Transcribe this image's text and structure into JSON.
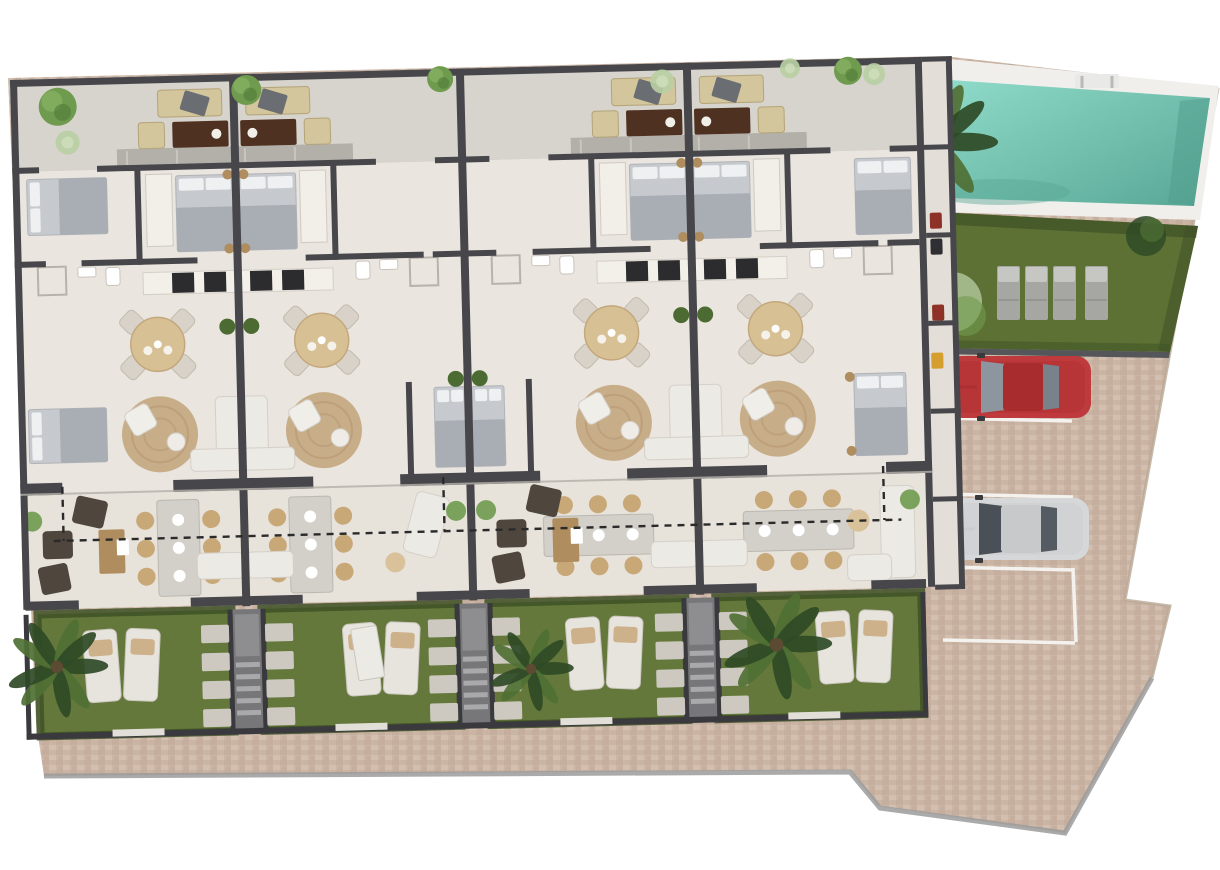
{
  "meta": {
    "kind": "architectural-site-plan",
    "view": "top-down 3d render",
    "units_count": 4,
    "description": "Four mirrored townhouse units with roof terraces, gardens, communal pool, lawn and parking"
  },
  "palette": {
    "background": "#ffffff",
    "paving": "#cbb6a6",
    "paving_dark": "#c0a897",
    "paving_light": "#d7c4b5",
    "curb": "#9b9b9b",
    "wall": "#47474b",
    "wall_dark": "#3a3a3e",
    "floor_interior": "#eae5de",
    "floor_terrace": "#d7d3cd",
    "floor_lower": "#e7e2da",
    "floor_strip": "#e3ded7",
    "balcony": "#b3afa9",
    "lawn": "#64783b",
    "lawn_dark": "#3e5126",
    "lawn_pool": "#5d7134",
    "pool_water": "#8fdac9",
    "pool_water_deep": "#58a795",
    "pool_deck": "#f1efec",
    "stone": "#d3cec7",
    "path_concrete": "#77777a",
    "step_tread": "#a9a9ac",
    "sofa_beige": "#d3c59c",
    "wood_dark": "#4e3121",
    "wood_mid": "#b08d5e",
    "rug_jute": "#c8ad89",
    "table_round_top": "#d8c095",
    "chair_pale": "#d8d2c8",
    "chair_tan": "#c9a877",
    "bed_light": "#c6c9cd",
    "bed_blanket": "#a9adb4",
    "pillow": "#eef0f2",
    "white_furniture": "#eceae5",
    "appliance_dark": "#2c2c2e",
    "plant_green": "#6f9b4e",
    "plant_pale": "#b9cfa4",
    "palm_dark": "#2f4a26",
    "palm_mid": "#4f7034",
    "dashed_line": "#2a2a2a",
    "lounger_gray": "#a6a7a2",
    "lounger_gray_top": "#c6c7c3",
    "car_red": "#bf3a3c",
    "car_red_roof": "#a82c2e",
    "car_silver": "#d6d7d9",
    "car_silver_roof": "#c8c9cb",
    "car_glass": "#8d969e",
    "car_glass_dark": "#4a5058",
    "accent_red_item": "#8e3127",
    "accent_yellow_item": "#d49f2e"
  },
  "units": [
    {
      "id": 1,
      "x0": 0,
      "x1": 223,
      "divider": "right",
      "table_orientation": "vertical",
      "lounge_accent": "dark-armchairs",
      "outer_bedrooms": "horizontal",
      "garden": {
        "loungers_x": 60,
        "palm": {
          "x": 32,
          "y": 588,
          "r": 48
        },
        "gate_x": 112
      }
    },
    {
      "id": 2,
      "x0": 223,
      "x1": 450,
      "divider": "left",
      "table_orientation": "vertical",
      "lounge_accent": "white-chaise",
      "mid_bed": "right",
      "garden": {
        "loungers_x": 320,
        "shed": {
          "x": 330,
          "y": 556
        },
        "gate_x": 335
      }
    },
    {
      "id": 3,
      "x0": 450,
      "x1": 677,
      "divider": "right",
      "table_orientation": "horizontal",
      "lounge_accent": "dark-armchairs",
      "mid_bed": "left",
      "garden": {
        "loungers_x": 543,
        "palm": {
          "x": 506,
          "y": 602,
          "r": 40
        },
        "gate_x": 560
      }
    },
    {
      "id": 4,
      "x0": 677,
      "x1": 905,
      "divider": "left",
      "table_orientation": "horizontal",
      "lounge_accent": "white-sectional",
      "outer_bedrooms": "vertical",
      "garden": {
        "loungers_x": 793,
        "palm": {
          "x": 752,
          "y": 584,
          "r": 52
        },
        "gate_x": 788
      }
    }
  ],
  "terrace_trees": [
    {
      "x": 47,
      "y": 28,
      "r": 19,
      "tone": "green"
    },
    {
      "x": 56,
      "y": 64,
      "r": 12,
      "tone": "pale"
    },
    {
      "x": 236,
      "y": 16,
      "r": 15,
      "tone": "green"
    },
    {
      "x": 430,
      "y": 10,
      "r": 13,
      "tone": "green"
    },
    {
      "x": 652,
      "y": 18,
      "r": 12,
      "tone": "pale"
    },
    {
      "x": 838,
      "y": 12,
      "r": 14,
      "tone": "green"
    },
    {
      "x": 780,
      "y": 8,
      "r": 10,
      "tone": "pale"
    },
    {
      "x": 864,
      "y": 16,
      "r": 11,
      "tone": "pale"
    }
  ],
  "pool_area": {
    "sun_loungers": 4,
    "has_ladder": true,
    "has_palm": true,
    "lounger_xs": [
      997,
      1025,
      1053,
      1085
    ]
  },
  "parking": {
    "marked_lines": 4,
    "cars": [
      {
        "color_name": "red",
        "x": 947,
        "y": 356
      },
      {
        "color_name": "silver",
        "x": 945,
        "y": 498
      }
    ]
  },
  "garden_features": {
    "loungers_per_garden": 2,
    "stepping_stone_rows": 4,
    "entry_paths": 3
  }
}
